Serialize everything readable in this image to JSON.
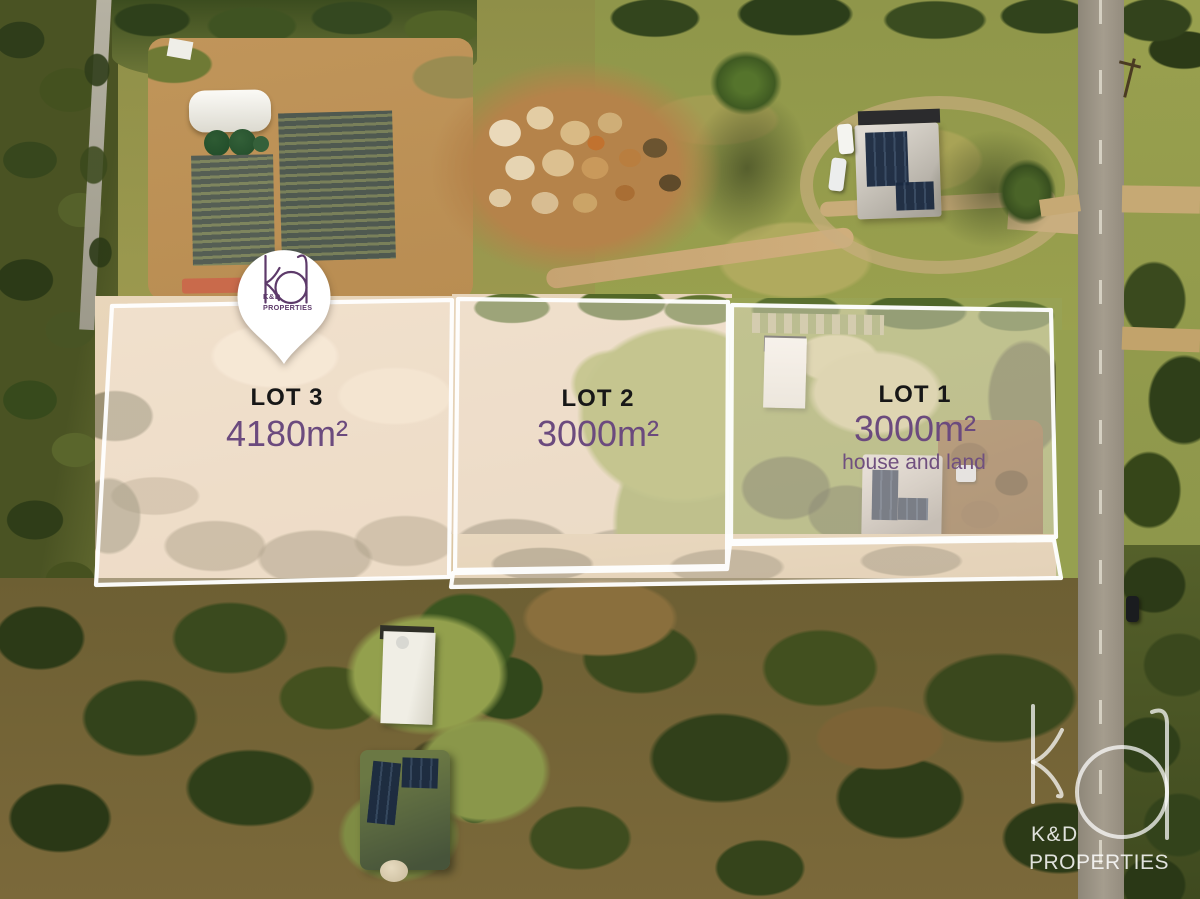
{
  "branding": {
    "pin": {
      "monogram": "kd",
      "name": "K&D",
      "subtitle": "PROPERTIES"
    },
    "watermark": {
      "monogram": "kd",
      "name": "K&D",
      "subtitle": "PROPERTIES"
    }
  },
  "lots": [
    {
      "label": "LOT 3",
      "area": "4180m²",
      "note": ""
    },
    {
      "label": "LOT 2",
      "area": "3000m²",
      "note": ""
    },
    {
      "label": "LOT 1",
      "area": "3000m²",
      "note": "house and land"
    }
  ],
  "colors": {
    "label_black": "#171717",
    "area_purple": "#6b4a7e",
    "logo_purple": "#5d3a6a",
    "outline_white": "#ffffff",
    "lot_wash": "rgba(253,241,232,0.42)"
  }
}
